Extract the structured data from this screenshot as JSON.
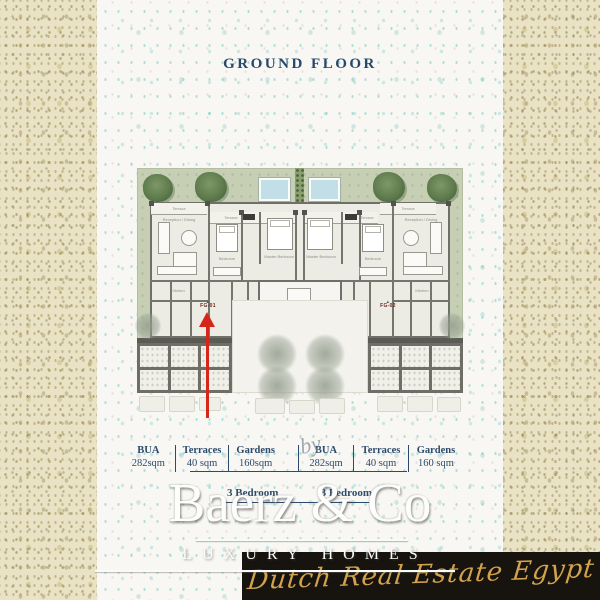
{
  "page": {
    "title": "GROUND FLOOR"
  },
  "plan": {
    "unit_left": "FG-01",
    "unit_right": "FG-02",
    "room_labels": {
      "terrace": "Terrace",
      "reception": "Reception / Dining",
      "master": "Master Bedroom",
      "bedroom": "Bedroom",
      "kitchen": "Kitchen"
    }
  },
  "specs": {
    "groups": [
      {
        "columns": [
          {
            "label": "BUA",
            "value": "282sqm"
          },
          {
            "label": "Terraces",
            "value": "40 sqm"
          },
          {
            "label": "Gardens",
            "value": "160sqm"
          }
        ]
      },
      {
        "columns": [
          {
            "label": "BUA",
            "value": "282sqm"
          },
          {
            "label": "Terraces",
            "value": "40 sqm"
          },
          {
            "label": "Gardens",
            "value": "160 sqm"
          }
        ]
      }
    ],
    "unit_types": [
      "3 Bedroom",
      "3 Bedroom"
    ]
  },
  "watermark": {
    "by": "by",
    "brand": "Baerz & Co",
    "tagline": "LUXURY HOMES"
  },
  "banner": {
    "text": "Dutch Real Estate Egypt"
  },
  "colors": {
    "outer_background": "#e9e2c4",
    "panel_background": "#f8f7f3",
    "title_navy": "#26496b",
    "garden_green": "#c6cfb4",
    "pool_blue": "#c2dfe7",
    "wall_gray": "#75756e",
    "arrow_red": "#d6261a",
    "banner_black": "#17130e",
    "banner_gold": "#d2a24c",
    "watermark_white": "#fdfdfb"
  }
}
